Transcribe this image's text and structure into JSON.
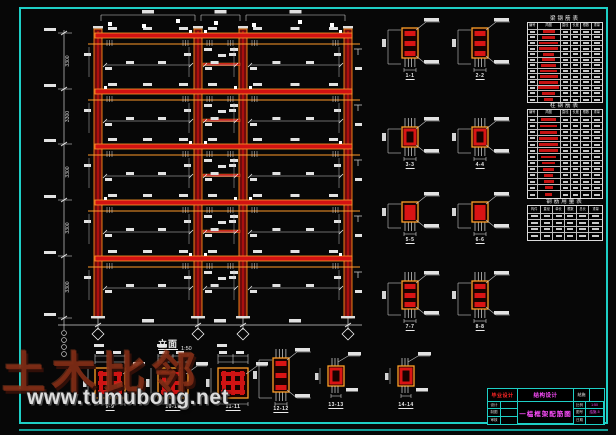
{
  "watermark": {
    "logo": "土木比邻",
    "url": "www.tumubong.net"
  },
  "drawing_label": {
    "name": "立面",
    "scale": "1:50"
  },
  "left_dim": {
    "stories": [
      "3300",
      "3300",
      "3300",
      "3300",
      "3300"
    ]
  },
  "right_sections": {
    "labels": [
      "1-1",
      "2-2",
      "3-3",
      "4-4",
      "5-5",
      "6-6",
      "7-7",
      "8-8"
    ]
  },
  "bottom_sections": {
    "labels": [
      "9-9",
      "10-10",
      "11-11",
      "12-12",
      "13-13",
      "14-14"
    ]
  },
  "tables": [
    {
      "title": "梁钢筋表",
      "headers": [
        "编号",
        "简图",
        "直径",
        "长度",
        "根数",
        "重量"
      ],
      "bars": [
        55,
        62,
        85,
        90,
        50,
        60,
        68,
        75,
        82,
        88,
        92,
        58,
        40
      ]
    },
    {
      "title": "柱钢筋表",
      "headers": [
        "编号",
        "简图",
        "直径",
        "长度",
        "根数",
        "重量"
      ],
      "bars": [
        68,
        75,
        80,
        85,
        88,
        90,
        72,
        60,
        52,
        44,
        46,
        36,
        30
      ]
    },
    {
      "title": "钢筋用量表",
      "headers": [
        "构件",
        "直径",
        "单长",
        "根数",
        "总长",
        "重量"
      ],
      "rows": 4
    }
  ],
  "titleblock": {
    "unit": "毕业设计",
    "project": "结构设计",
    "category": "结施",
    "left_rows": [
      "设计",
      "制图",
      "审核"
    ],
    "main_title": "一榀框架配筋图",
    "right_rows": [
      {
        "label": "比例",
        "value": "1:50"
      },
      {
        "label": "图号",
        "value": "结施-5"
      },
      {
        "label": "日期",
        "value": ""
      }
    ]
  },
  "colors": {
    "border_cyan": "#1ecfc6",
    "beam_red": "#d21212",
    "column_maroon": "#6f0c0c",
    "outline_orange": "#ffa028",
    "annotation_white": "#e6e6e6",
    "table_bar_red": "#c61212",
    "magenta": "#ff4dff",
    "title_red": "#ff2626"
  }
}
